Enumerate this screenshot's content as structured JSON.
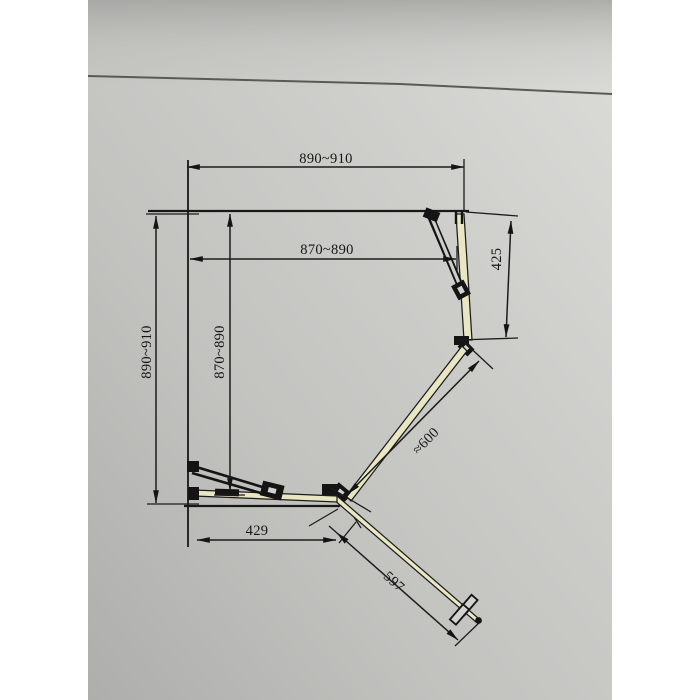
{
  "scene": {
    "paper_color": "#c8c8c5",
    "margin_color": "#ffffff",
    "line_color": "#1c1c1c",
    "glass_color": "#e9e7c3"
  },
  "dimensions": {
    "outer_width": "890~910",
    "inner_width": "870~890",
    "outer_depth": "890~910",
    "inner_depth": "870~890",
    "right_panel": "425",
    "door_diagonal": "≈600",
    "bottom_panel": "429",
    "door_open": "597"
  }
}
